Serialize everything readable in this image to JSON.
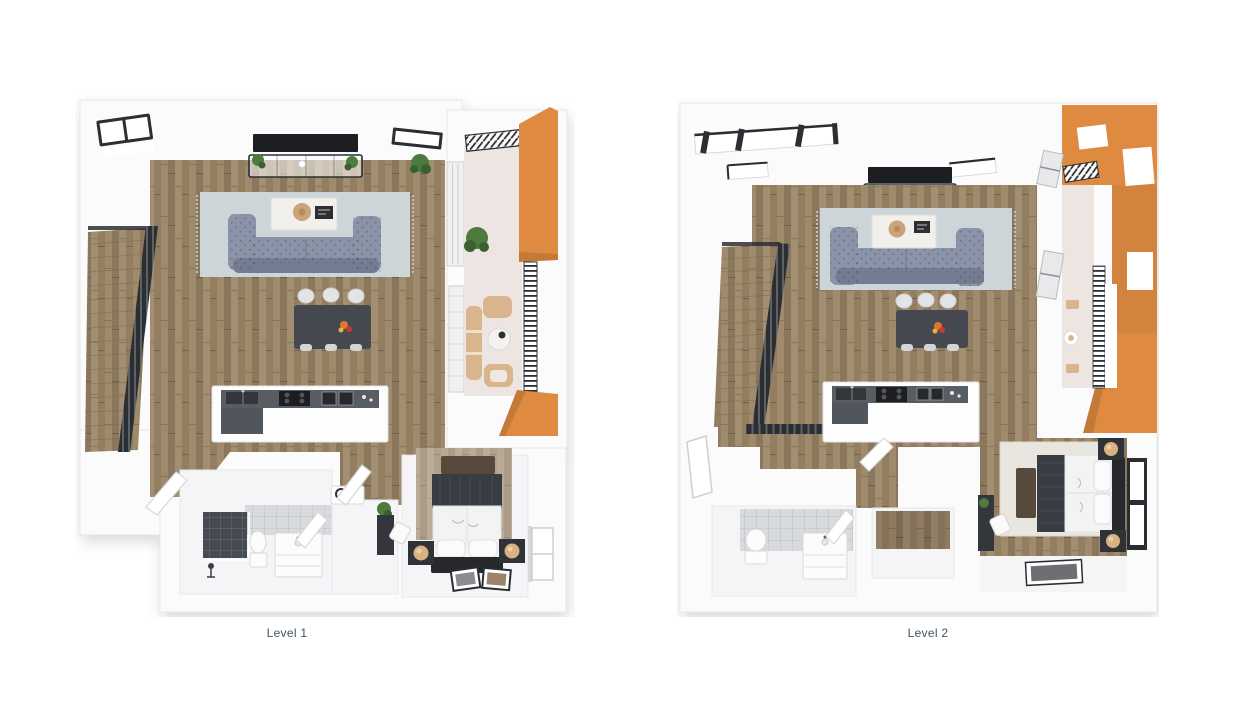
{
  "page": {
    "title": "3D floor plan — two levels"
  },
  "plans": [
    {
      "id": "level-1",
      "label": "Level 1"
    },
    {
      "id": "level-2",
      "label": "Level 2"
    }
  ],
  "colors": {
    "background": "#ffffff",
    "wall_white": "#fbfbfc",
    "wall_face": "#f2f2f4",
    "wall_edge": "#e7e7ea",
    "wood_floor": "#9b8566",
    "accent_orange": "#de8b41",
    "accent_orange_dark": "#c06a24",
    "balcony_floor": "#ede5e1",
    "rug_gray": "#cdd5d8",
    "bedroom_rug": "#e9e5df",
    "sofa_gray": "#8b93a8",
    "sofa_gray_dark": "#747c92",
    "charcoal_table": "#45494f",
    "counter_gray": "#585d64",
    "appliance_black": "#1c1e21",
    "metal_dark": "#2b2e32",
    "tan_chair": "#d9b58e",
    "lamp_tan": "#d9b27f",
    "tray_tan": "#c9a37b",
    "plant_green": "#4d7a3d",
    "plant_green_dark": "#3a6030",
    "tile_dark": "#464b52",
    "tile_light": "#d8dbde",
    "blanket_dark": "#393c42",
    "headboard_brown": "#57493c",
    "bed_white": "#f3f3f4",
    "label_text": "#3b5560"
  }
}
